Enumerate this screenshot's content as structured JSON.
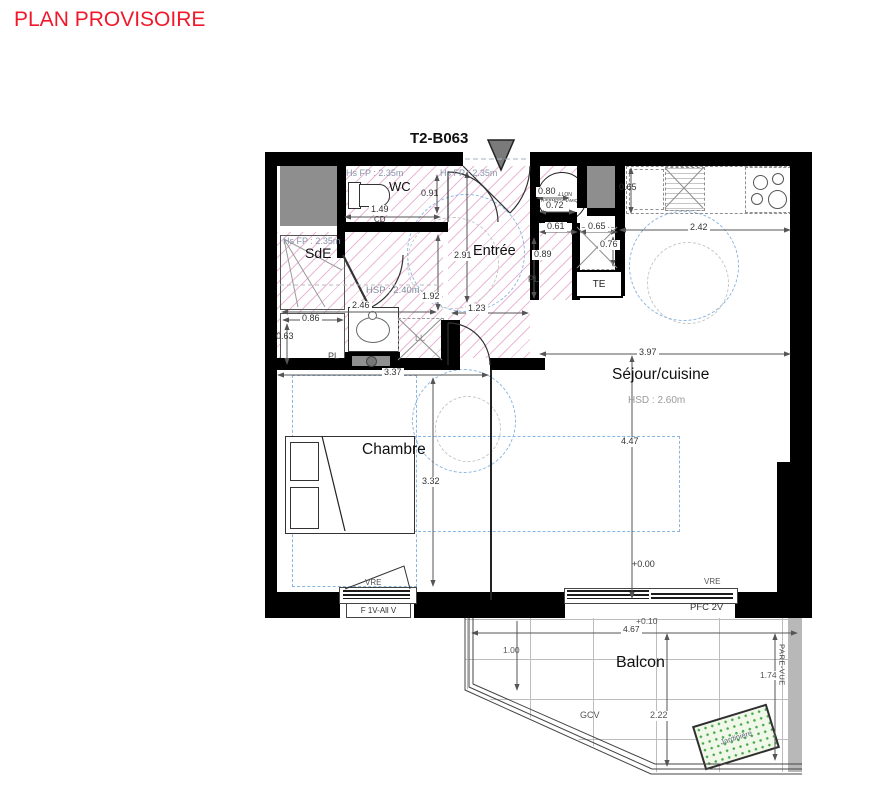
{
  "header": {
    "title": "PLAN PROVISOIRE",
    "lot": "T2-B063"
  },
  "rooms": {
    "wc": {
      "name": "WC",
      "ceiling": "Hs FP : 2.35m"
    },
    "sde": {
      "name": "SdE",
      "ceiling": "Hs FP : 2.35m",
      "hsp": "HSP : 2.40m"
    },
    "entree": {
      "name": "Entrée",
      "ceiling": "Hs FP : 2.35m"
    },
    "sejour": {
      "name": "Séjour/cuisine",
      "hsd": "HSD : 2.60m",
      "level": "+0.00"
    },
    "chambre": {
      "name": "Chambre"
    },
    "balcon": {
      "name": "Balcon",
      "level": "+0.10"
    }
  },
  "dims": {
    "wc_width": "1.49",
    "wc_depth": "0.91",
    "wc_door": "CD",
    "sde_width": "2.46",
    "sde_depth": "1.92",
    "sde_passage": "1.23",
    "pl_width": "0.86",
    "pl_depth": "0.63",
    "entree_length": "2.91",
    "hall_a": "0.61",
    "hall_b": "0.65",
    "hall_c": "0.76",
    "hall_d": "0.89",
    "ballon_a": "0.80",
    "ballon_b": "0.72",
    "kitchen_depth": "0.65",
    "kitchen_width": "2.42",
    "sejour_width": "3.97",
    "sejour_length": "4.47",
    "chambre_width": "3.37",
    "chambre_length": "3.32",
    "balcon_width": "4.67",
    "balcon_a": "1.00",
    "balcon_b": "2.22",
    "balcon_c": "1.74"
  },
  "fixtures": {
    "ballon_line1": "BALLON",
    "ballon_line2": "THERMODYNAMIQUE",
    "washing_machine": "LL",
    "closet_sde": "PL",
    "closet_hall": "PL",
    "elec_panel": "TE"
  },
  "windows": {
    "chambre_shutter": "VRE",
    "chambre_type": "F 1V-All V",
    "sejour_shutter": "VRE",
    "sejour_type": "PFC 2V"
  },
  "balcony": {
    "railing": "GCV",
    "screen": "PARE-VUE",
    "planter": "Jardinière"
  },
  "colors": {
    "title_red": "#f0182a",
    "hatch_pink": "#ce55a0",
    "accessibility_blue": "#8ab6e2",
    "wall_black": "#000000",
    "duct_gray": "#8e8e8e",
    "planter_green": "#4aa94a",
    "screen_gray": "#b8b8b8"
  }
}
